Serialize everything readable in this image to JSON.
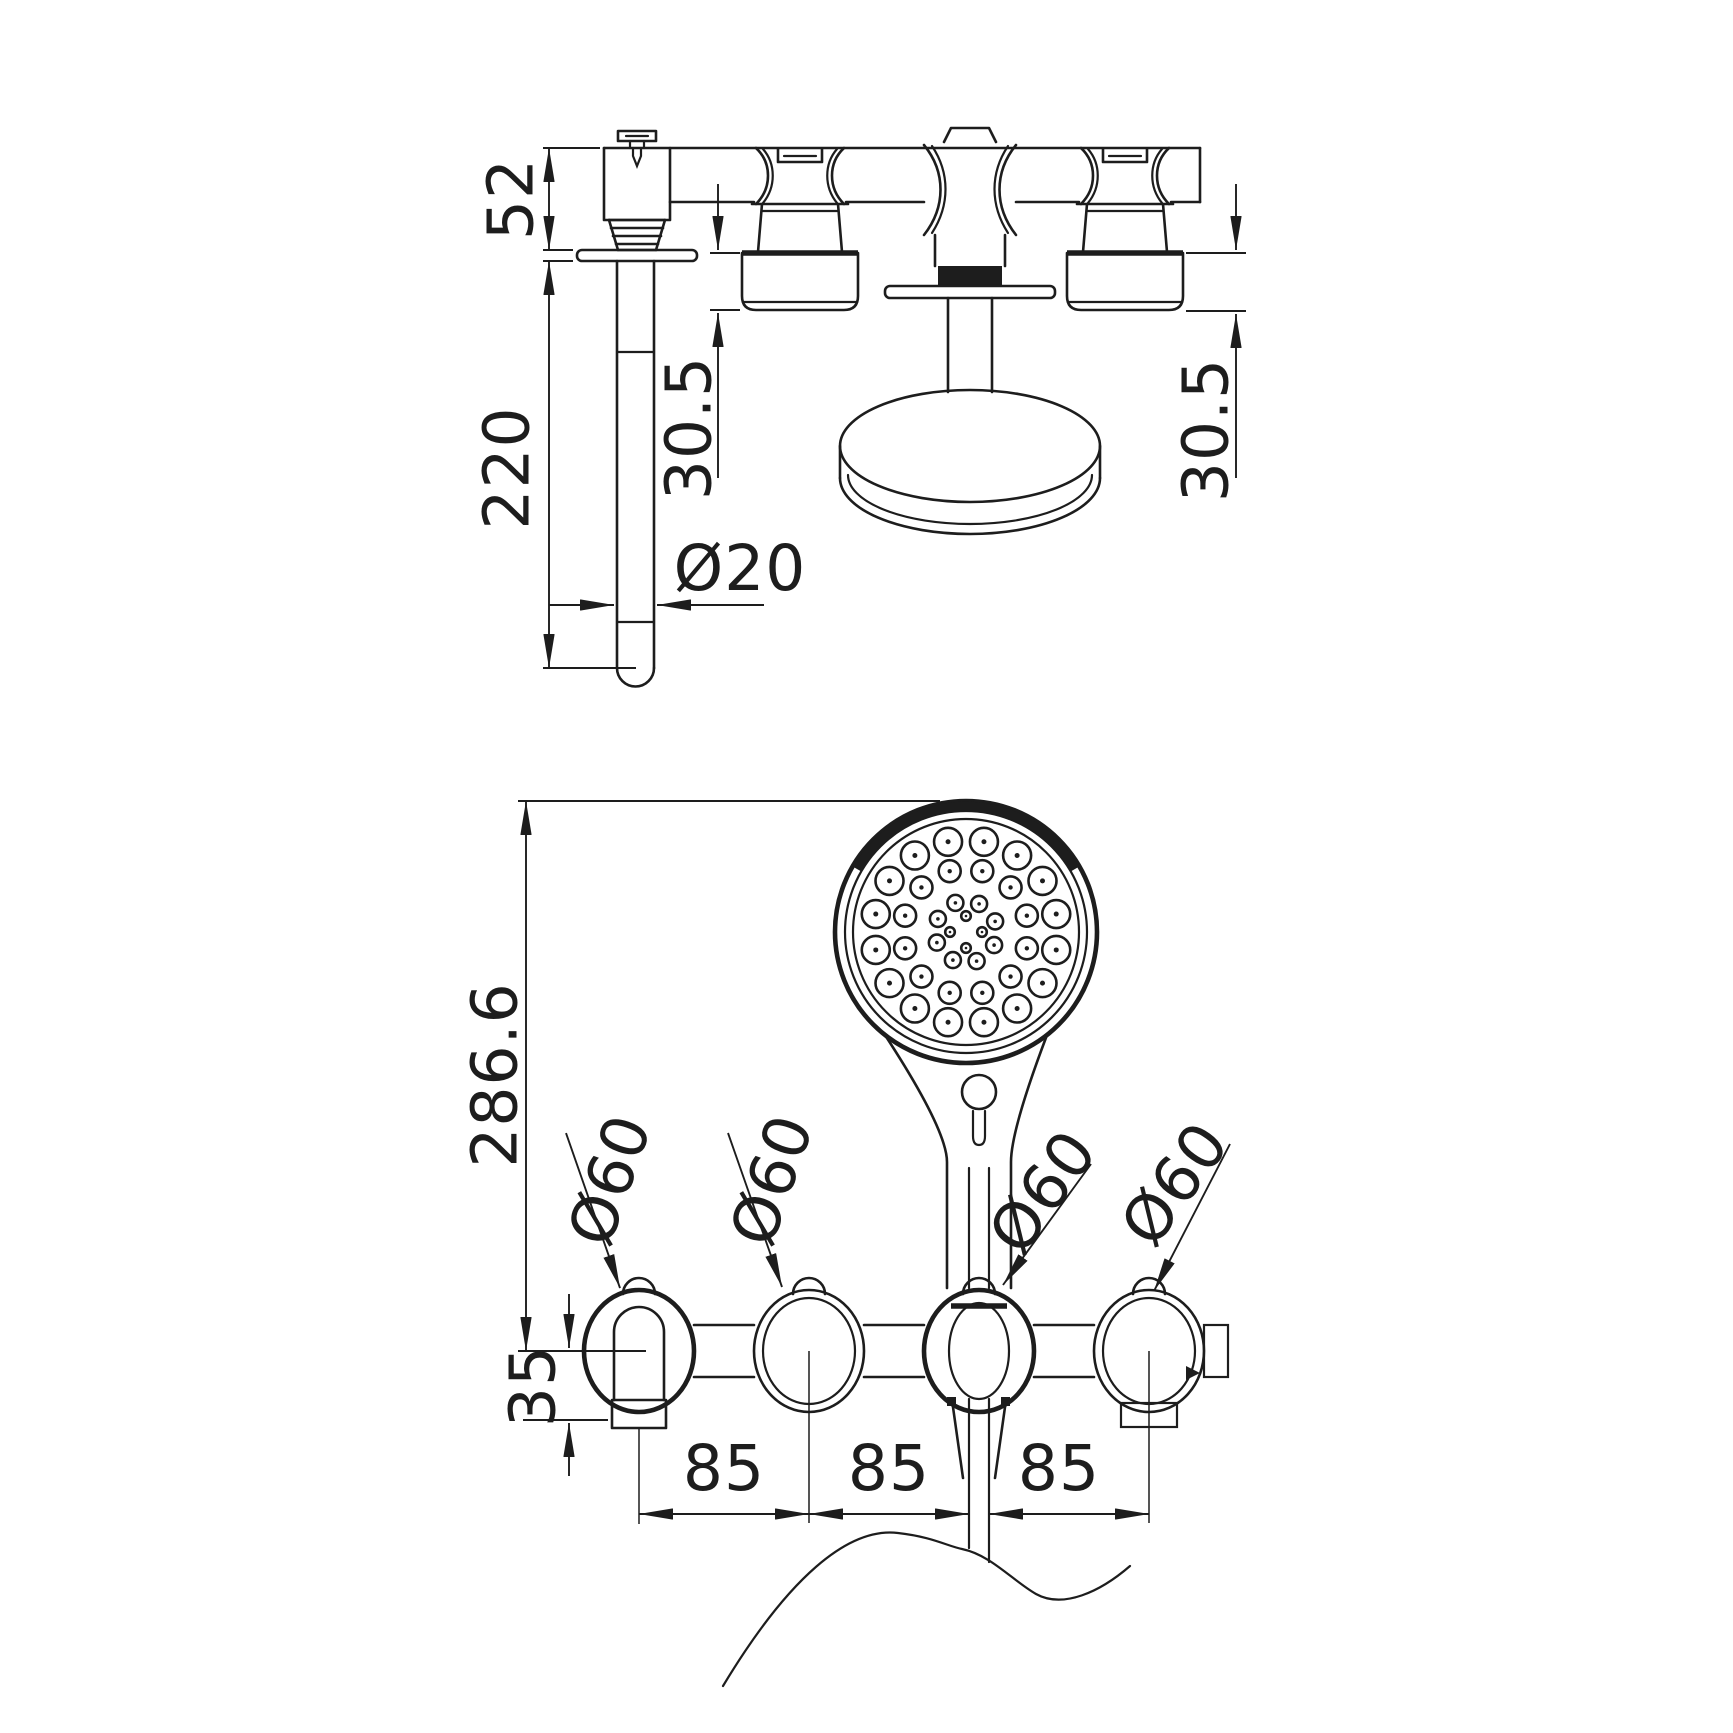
{
  "page": {
    "background": "#ffffff",
    "line_color": "#1d1d1d"
  },
  "drawing": {
    "type": "technical dimension drawing",
    "subject": "wall-mounted bath shower mixer with hand shower, two views",
    "units": "mm",
    "side_view": {
      "dim_spout_offset": "52",
      "dim_spout_length": "220",
      "dim_handle_depth_left": "30.5",
      "dim_handle_depth_right": "30.5",
      "dim_spout_diameter": "Ø20"
    },
    "front_view": {
      "dim_overall_height": "286.6",
      "dim_outlet_drop": "35",
      "dim_spacing_left": "85",
      "dim_spacing_center": "85",
      "dim_spacing_right": "85",
      "dim_knob1_diameter": "Ø60",
      "dim_knob2_diameter": "Ø60",
      "dim_knob3_diameter": "Ø60",
      "dim_knob4_diameter": "Ø60"
    }
  }
}
